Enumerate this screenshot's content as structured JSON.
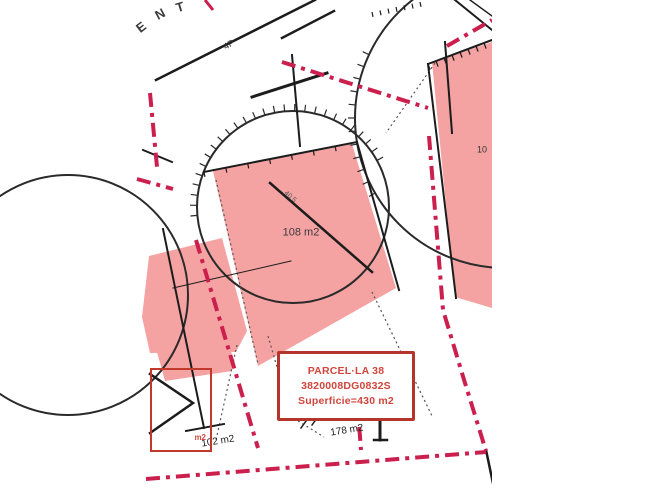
{
  "map": {
    "width": 650,
    "height": 488,
    "content_width": 492,
    "colors": {
      "background": "#ffffff",
      "parcel_fill": "#f5a2a2",
      "boundary_red": "#cb1f4d",
      "line_black": "#1c1c1c",
      "circle_stroke": "#2a2a2a",
      "dotted_gray": "#555555",
      "info_border_red": "#b5352c",
      "info_text_red": "#d0453c"
    },
    "info_box": {
      "lines": [
        "PARCEL·LA 38",
        "3820008DG0832S",
        "Superficie=430 m2"
      ]
    },
    "small_box": {
      "m2_label": "m2"
    },
    "labels": [
      {
        "name": "street-letter-e",
        "text": "E",
        "x": 141,
        "y": 27,
        "rot": -38,
        "size": 13,
        "color": "#3a3a3a",
        "bold": true
      },
      {
        "name": "street-letter-n",
        "text": "N",
        "x": 160,
        "y": 14,
        "rot": -28,
        "size": 13,
        "color": "#3a3a3a",
        "bold": true
      },
      {
        "name": "street-letter-t",
        "text": "T",
        "x": 180,
        "y": 7,
        "rot": -16,
        "size": 13,
        "color": "#3a3a3a",
        "bold": true
      },
      {
        "name": "floors-label",
        "text": "4P",
        "x": 229,
        "y": 45,
        "rot": -30,
        "size": 9,
        "color": "#333333",
        "bold": false
      },
      {
        "name": "area-label-central",
        "text": "108 m2",
        "x": 301,
        "y": 233,
        "rot": 0,
        "size": 11,
        "color": "#3a3a3a",
        "bold": false
      },
      {
        "name": "dimension-label",
        "text": "40.5",
        "x": 290,
        "y": 197,
        "rot": 41,
        "size": 7,
        "color": "#555555",
        "bold": false
      },
      {
        "name": "clipped-area-label",
        "text": "10",
        "x": 482,
        "y": 150,
        "rot": 0,
        "size": 9,
        "color": "#333333",
        "bold": false
      },
      {
        "name": "area-label-left",
        "text": "102 m2",
        "x": 218,
        "y": 442,
        "rot": -9,
        "size": 10,
        "color": "#222222",
        "bold": false
      },
      {
        "name": "area-label-bottom",
        "text": "178 m2",
        "x": 347,
        "y": 431,
        "rot": -9,
        "size": 10,
        "color": "#222222",
        "bold": false
      }
    ],
    "circles": [
      {
        "name": "survey-circle-main",
        "cx": 293,
        "cy": 207,
        "r": 96
      },
      {
        "name": "survey-circle-right",
        "cx": 505,
        "cy": 118,
        "r": 150
      },
      {
        "name": "survey-circle-left",
        "cx": 68,
        "cy": 295,
        "r": 120
      }
    ],
    "arc_ticks": [
      {
        "name": "hatch-circle-main",
        "cx": 293,
        "cy": 207,
        "r": 96,
        "from": 175,
        "to": 335,
        "step": 6,
        "len": 7
      },
      {
        "name": "hatch-circle-right",
        "cx": 505,
        "cy": 118,
        "r": 150,
        "from": 150,
        "to": 205,
        "step": 5,
        "len": 7
      }
    ],
    "polygons": [
      {
        "name": "parcel-central",
        "points": [
          [
            213,
            171
          ],
          [
            352,
            144
          ],
          [
            396,
            288
          ],
          [
            258,
            366
          ]
        ]
      },
      {
        "name": "parcel-right",
        "points": [
          [
            432,
            62
          ],
          [
            492,
            42
          ],
          [
            492,
            308
          ],
          [
            455,
            297
          ]
        ]
      },
      {
        "name": "parcel-left",
        "points": [
          [
            149,
            256
          ],
          [
            222,
            238
          ],
          [
            247,
            331
          ],
          [
            236,
            352
          ],
          [
            150,
            353
          ],
          [
            142,
            317
          ]
        ]
      },
      {
        "name": "parcel-left-lower",
        "points": [
          [
            157,
            352
          ],
          [
            231,
            337
          ],
          [
            232,
            371
          ],
          [
            165,
            381
          ]
        ]
      }
    ],
    "lines": [
      {
        "name": "street-edge",
        "points": [
          [
            156,
            80
          ],
          [
            315,
            0
          ]
        ],
        "w": 2.5
      },
      {
        "name": "street-edge-2",
        "points": [
          [
            282,
            38
          ],
          [
            334,
            11
          ]
        ],
        "w": 2.5
      },
      {
        "name": "survey-vertical-top",
        "points": [
          [
            292,
            55
          ],
          [
            300,
            146
          ]
        ],
        "w": 2
      },
      {
        "name": "survey-bar",
        "points": [
          [
            252,
            97
          ],
          [
            327,
            73
          ]
        ],
        "w": 3
      },
      {
        "name": "survey-vertical-right",
        "points": [
          [
            445,
            42
          ],
          [
            452,
            133
          ]
        ],
        "w": 2
      },
      {
        "name": "central-outline",
        "points": [
          [
            204,
            172
          ],
          [
            357,
            142
          ],
          [
            399,
            290
          ]
        ],
        "w": 2
      },
      {
        "name": "central-diagonal",
        "points": [
          [
            270,
            183
          ],
          [
            372,
            272
          ]
        ],
        "w": 2.5
      },
      {
        "name": "left-boundary",
        "points": [
          [
            163,
            229
          ],
          [
            204,
            428
          ]
        ],
        "w": 2
      },
      {
        "name": "left-tbar",
        "points": [
          [
            186,
            431
          ],
          [
            224,
            424
          ]
        ],
        "w": 2
      },
      {
        "name": "left-dimension-line",
        "points": [
          [
            173,
            288
          ],
          [
            291,
            261
          ]
        ],
        "w": 1
      },
      {
        "name": "right-parcel-top-edge",
        "points": [
          [
            428,
            64
          ],
          [
            492,
            40
          ]
        ],
        "w": 2
      },
      {
        "name": "right-parcel-left-edge",
        "points": [
          [
            428,
            64
          ],
          [
            456,
            298
          ]
        ],
        "w": 2
      },
      {
        "name": "topright-edge-1",
        "points": [
          [
            455,
            0
          ],
          [
            492,
            30
          ]
        ],
        "w": 2
      },
      {
        "name": "topright-edge-2",
        "points": [
          [
            470,
            0
          ],
          [
            492,
            16
          ]
        ],
        "w": 1.5
      },
      {
        "name": "chevron-mark",
        "points": [
          [
            150,
            374
          ],
          [
            193,
            403
          ],
          [
            150,
            433
          ]
        ],
        "w": 2.5
      },
      {
        "name": "monument-vertical",
        "points": [
          [
            380,
            418
          ],
          [
            380,
            440
          ]
        ],
        "w": 3
      },
      {
        "name": "monument-base",
        "points": [
          [
            374,
            440
          ],
          [
            387,
            440
          ]
        ],
        "w": 2.5
      },
      {
        "name": "leader-tick-a",
        "points": [
          [
            301,
            428
          ],
          [
            306,
            421
          ]
        ],
        "w": 1.5
      },
      {
        "name": "leader-tick-b",
        "points": [
          [
            312,
            425
          ],
          [
            317,
            418
          ]
        ],
        "w": 1.5
      },
      {
        "name": "left-stub",
        "points": [
          [
            143,
            150
          ],
          [
            172,
            162
          ]
        ],
        "w": 2
      },
      {
        "name": "corner-bottom-right",
        "points": [
          [
            486,
            450
          ],
          [
            494,
            488
          ]
        ],
        "w": 2.5
      }
    ],
    "dotted": [
      {
        "name": "dotted-right-corner",
        "points": [
          [
            435,
            63
          ],
          [
            386,
            133
          ]
        ]
      },
      {
        "name": "dotted-central-se",
        "points": [
          [
            372,
            292
          ],
          [
            433,
            418
          ]
        ]
      },
      {
        "name": "dotted-below-box",
        "points": [
          [
            298,
            421
          ],
          [
            324,
            437
          ]
        ]
      },
      {
        "name": "dotted-left-lower",
        "points": [
          [
            237,
            345
          ],
          [
            216,
            440
          ]
        ]
      },
      {
        "name": "dotted-box-left",
        "points": [
          [
            268,
            336
          ],
          [
            279,
            374
          ]
        ]
      },
      {
        "name": "dotted-central-left-edge",
        "points": [
          [
            216,
            180
          ],
          [
            258,
            364
          ]
        ]
      }
    ],
    "red_paths": [
      {
        "name": "boundary-top",
        "points": [
          [
            282,
            62
          ],
          [
            428,
            108
          ]
        ],
        "w": 4
      },
      {
        "name": "boundary-right",
        "points": [
          [
            429,
            136
          ],
          [
            443,
            310
          ],
          [
            465,
            383
          ],
          [
            486,
            451
          ]
        ],
        "w": 4
      },
      {
        "name": "boundary-bottom",
        "points": [
          [
            146,
            479
          ],
          [
            486,
            452
          ]
        ],
        "w": 4
      },
      {
        "name": "boundary-stub",
        "points": [
          [
            357,
            397
          ],
          [
            361,
            450
          ]
        ],
        "w": 4
      },
      {
        "name": "boundary-left-vertical",
        "points": [
          [
            150,
            93
          ],
          [
            157,
            167
          ]
        ],
        "w": 4
      },
      {
        "name": "boundary-left-horizontal",
        "points": [
          [
            137,
            179
          ],
          [
            173,
            189
          ]
        ],
        "w": 4
      },
      {
        "name": "boundary-middle-diagonal",
        "points": [
          [
            196,
            240
          ],
          [
            258,
            448
          ]
        ],
        "w": 4
      },
      {
        "name": "boundary-topright",
        "points": [
          [
            447,
            46
          ],
          [
            492,
            20
          ]
        ],
        "w": 4
      },
      {
        "name": "boundary-topleft-tick",
        "points": [
          [
            205,
            0
          ],
          [
            213,
            10
          ]
        ],
        "w": 3
      }
    ],
    "edge_ticks": [
      {
        "name": "hatch-right-parcel-top",
        "x1": 428,
        "y1": 64,
        "x2": 492,
        "y2": 40,
        "n": 8,
        "len": 6
      },
      {
        "name": "hatch-central-top",
        "x1": 204,
        "y1": 172,
        "x2": 357,
        "y2": 142,
        "n": 7,
        "len": 5
      },
      {
        "name": "hatch-topright",
        "x1": 372,
        "y1": 12,
        "x2": 420,
        "y2": 2,
        "n": 6,
        "len": 5
      }
    ]
  }
}
